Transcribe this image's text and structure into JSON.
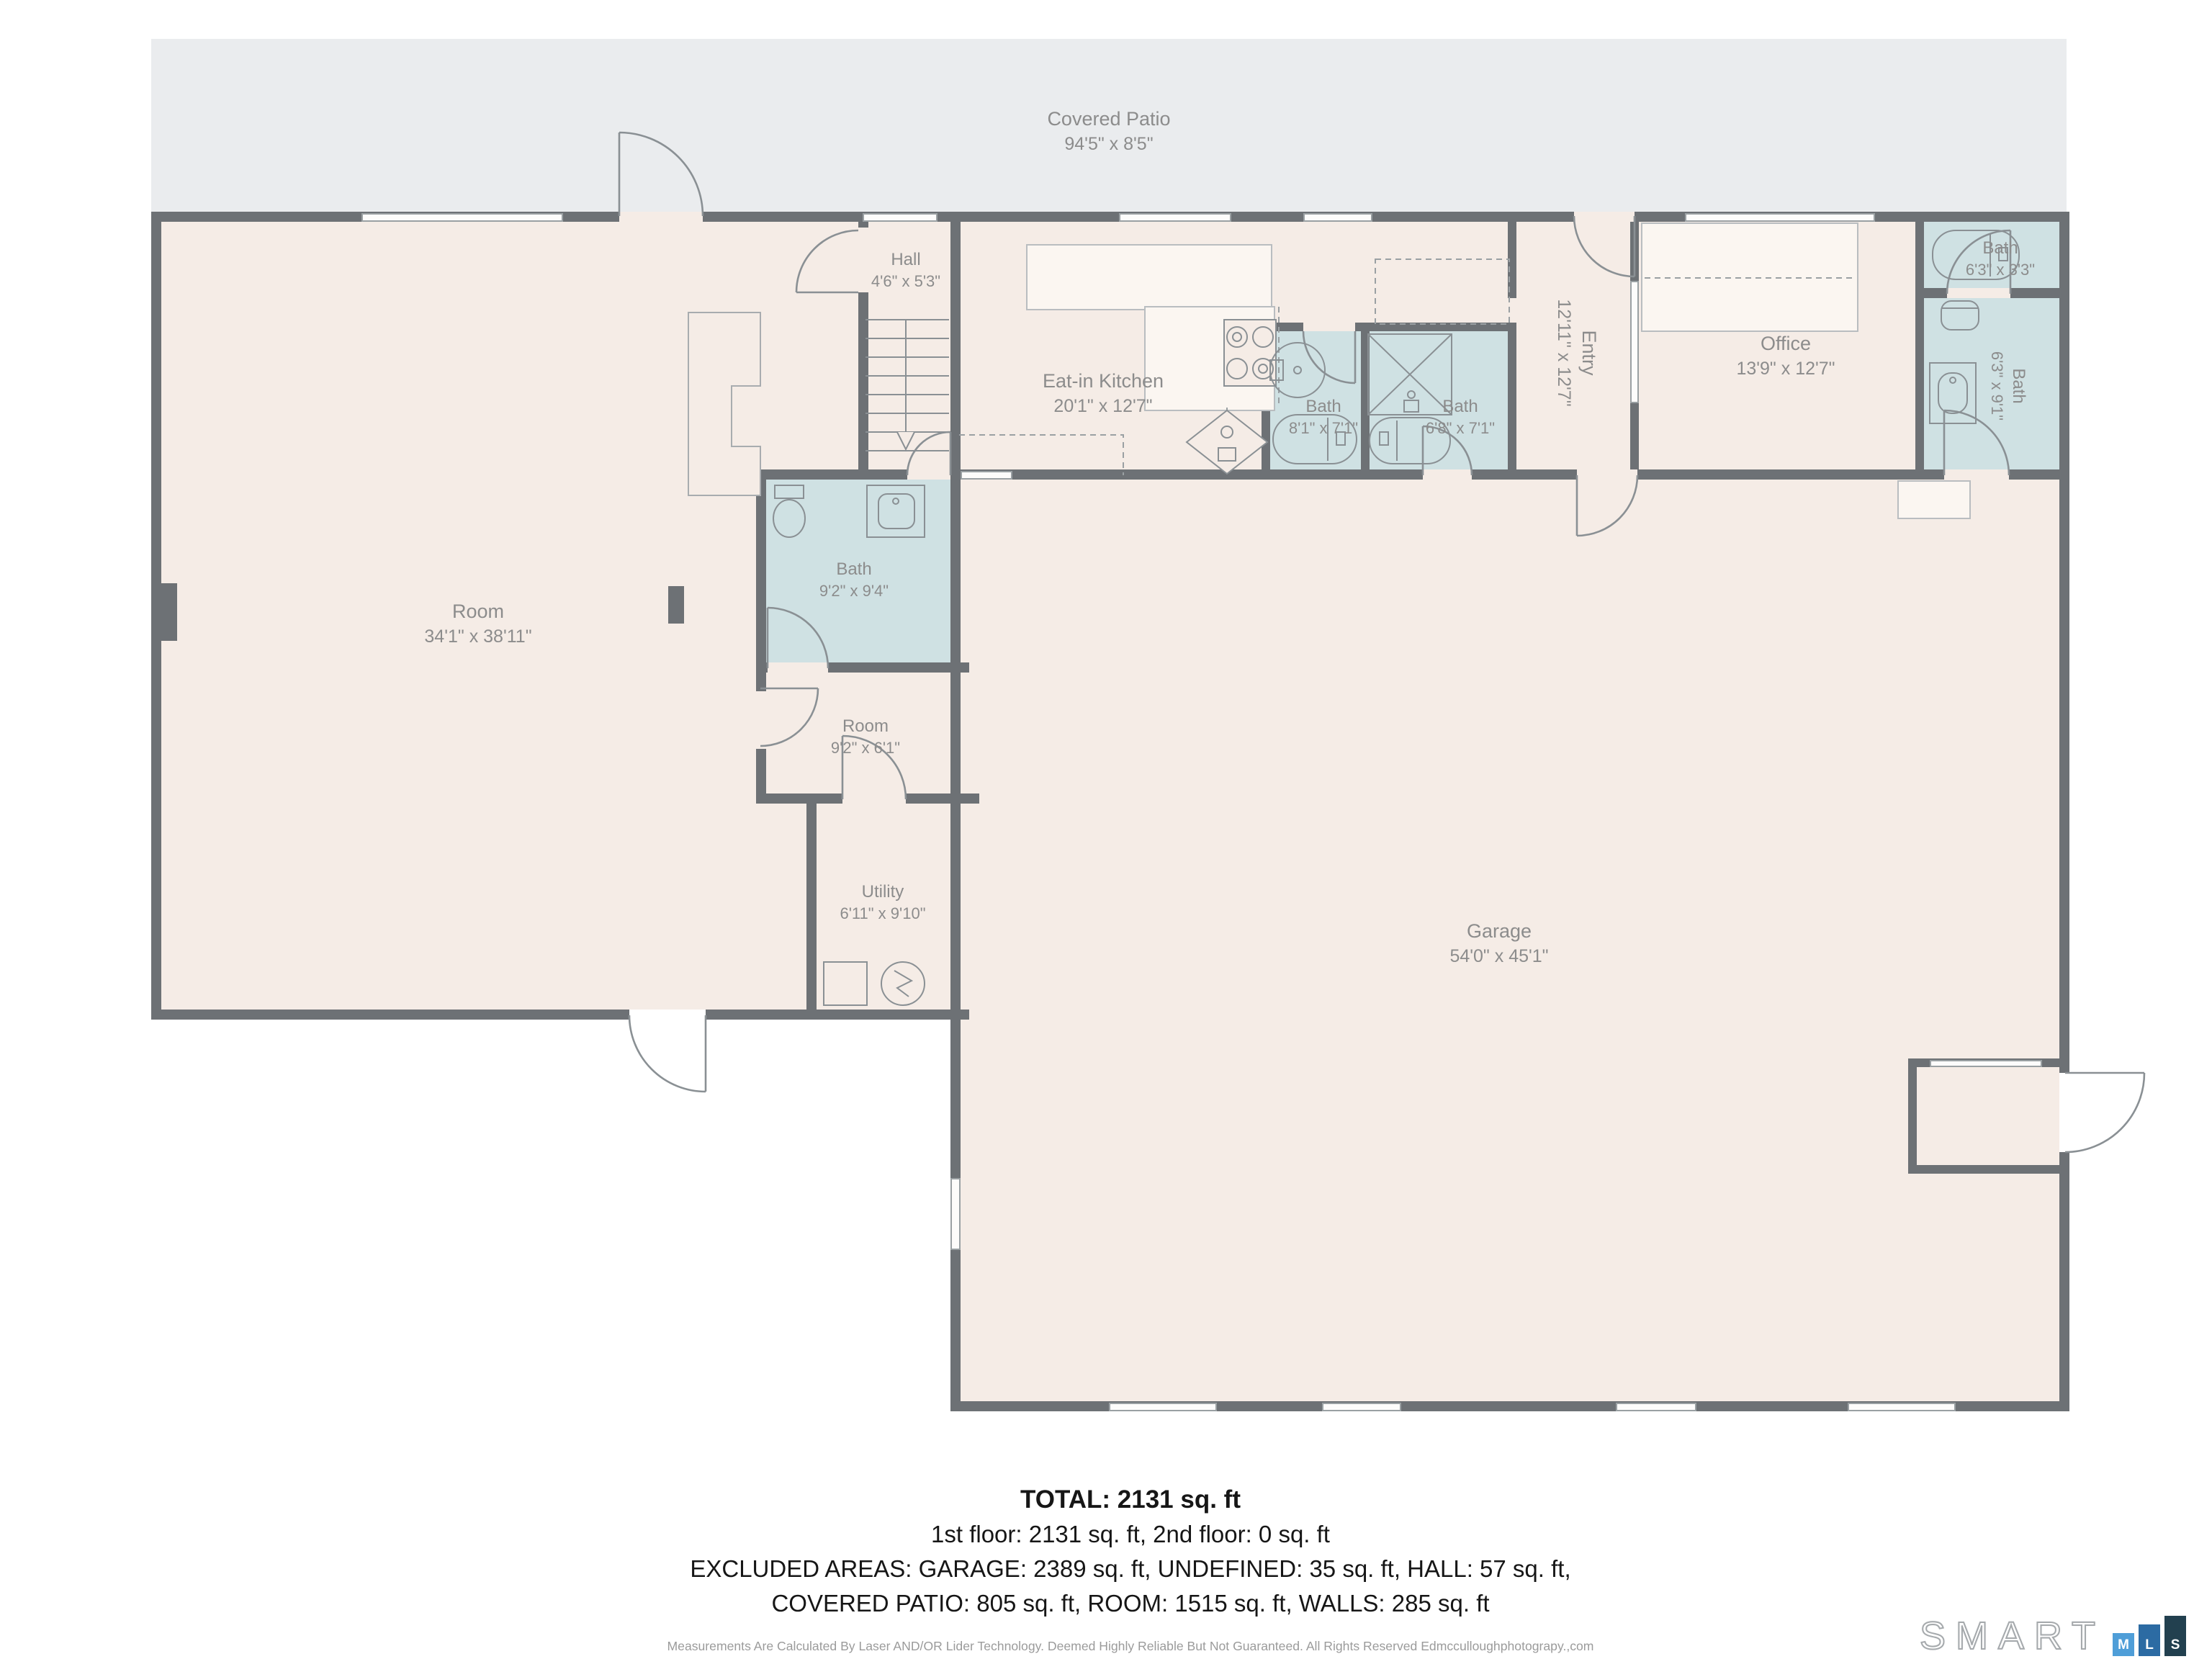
{
  "rooms": {
    "covered_patio": {
      "name": "Covered Patio",
      "dims": "94'5\" x 8'5\""
    },
    "room_left": {
      "name": "Room",
      "dims": "34'1\" x 38'11\""
    },
    "hall": {
      "name": "Hall",
      "dims": "4'6\" x 5'3\""
    },
    "eat_in_kitchen": {
      "name": "Eat-in Kitchen",
      "dims": "20'1\" x 12'7\""
    },
    "bath_a": {
      "name": "Bath",
      "dims": "8'1\" x 7'1\""
    },
    "bath_b": {
      "name": "Bath",
      "dims": "6'8\" x 7'1\""
    },
    "entry": {
      "name": "Entry",
      "dims": "12'11\" x 12'7\""
    },
    "office": {
      "name": "Office",
      "dims": "13'9\" x 12'7\""
    },
    "bath_c": {
      "name": "Bath",
      "dims": "6'3\" x 3'3\""
    },
    "bath_d": {
      "name": "Bath",
      "dims": "6'3\" x 9'1\""
    },
    "bath_mid": {
      "name": "Bath",
      "dims": "9'2\" x 9'4\""
    },
    "room_small": {
      "name": "Room",
      "dims": "9'2\" x 6'1\""
    },
    "utility": {
      "name": "Utility",
      "dims": "6'11\" x 9'10\""
    },
    "garage": {
      "name": "Garage",
      "dims": "54'0\" x 45'1\""
    }
  },
  "summary": {
    "total": "TOTAL: 2131 sq. ft",
    "floors": "1st floor: 2131 sq. ft, 2nd floor: 0 sq. ft",
    "excluded_1": "EXCLUDED AREAS: GARAGE: 2389 sq. ft, UNDEFINED: 35 sq. ft, HALL: 57 sq. ft,",
    "excluded_2": "COVERED PATIO: 805 sq. ft, ROOM: 1515 sq. ft, WALLS: 285 sq. ft"
  },
  "disclaimer": "Measurements Are Calculated By Laser AND/OR Lider Technology. Deemed Highly Reliable But Not Guaranteed. All Rights Reserved Edmcculloughphotograpy.,com",
  "logo": {
    "word": "SMART",
    "block_m": "M",
    "block_l": "L",
    "block_s": "S"
  },
  "colors": {
    "floor": "#f5ece6",
    "patio": "#eaecee",
    "bath": "#cfe1e3",
    "wall": "#6d7175",
    "label_text": "#8c8c8c",
    "summary_text": "#161616",
    "logo_m": "#4f9ed8",
    "logo_l": "#2c6ba3",
    "logo_s": "#22404f"
  }
}
